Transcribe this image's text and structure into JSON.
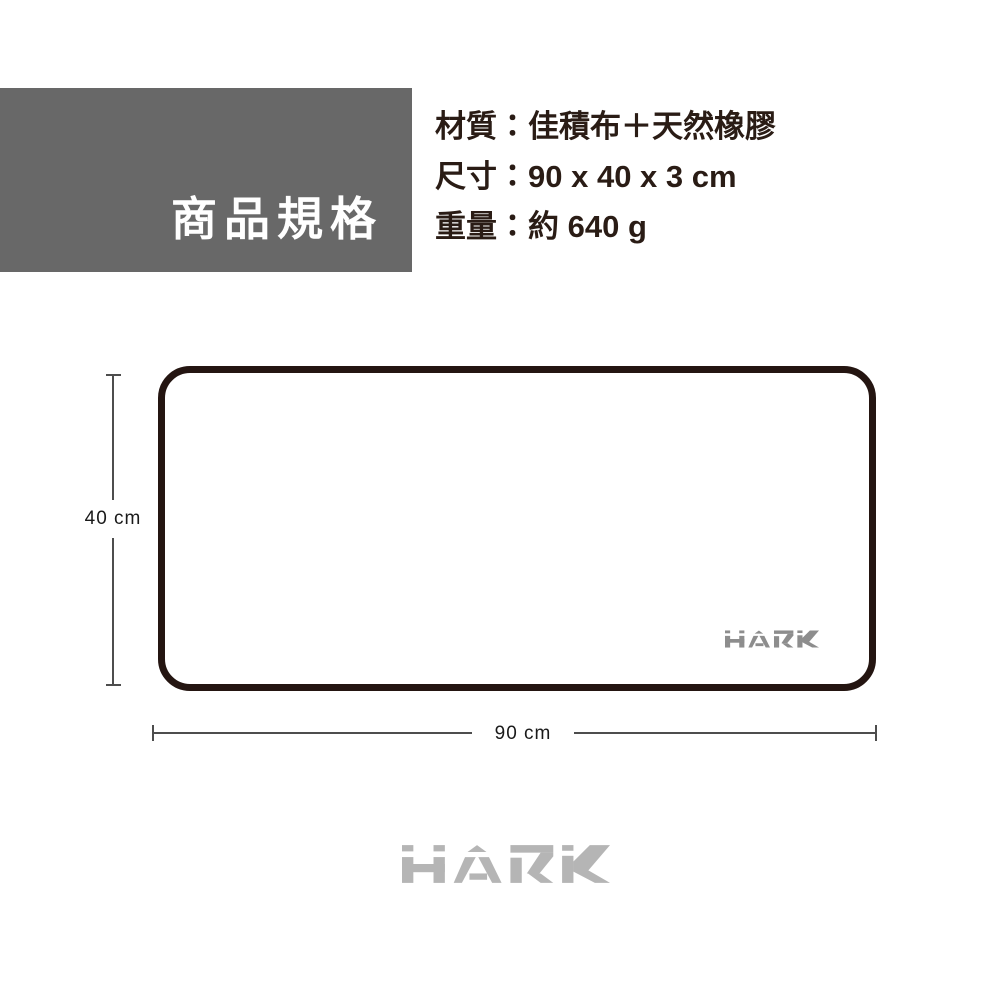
{
  "header": {
    "title": "商品規格"
  },
  "specs": {
    "material": "材質：佳積布＋天然橡膠",
    "size": "尺寸：90 x 40 x 3 cm",
    "weight": "重量：約 640 g"
  },
  "diagram": {
    "height_label": "40 cm",
    "width_label": "90 cm",
    "pad_logo_text": "HARK"
  },
  "footer": {
    "logo_text": "HARK"
  },
  "colors": {
    "header_bg": "#686868",
    "header_text": "#ffffff",
    "spec_text": "#2a1c15",
    "pad_border": "#241511",
    "dim_line": "#4d4d4d",
    "dim_text": "#1a1a1a",
    "pad_logo": "#8d8d8d",
    "footer_logo": "#b5b5b5"
  }
}
